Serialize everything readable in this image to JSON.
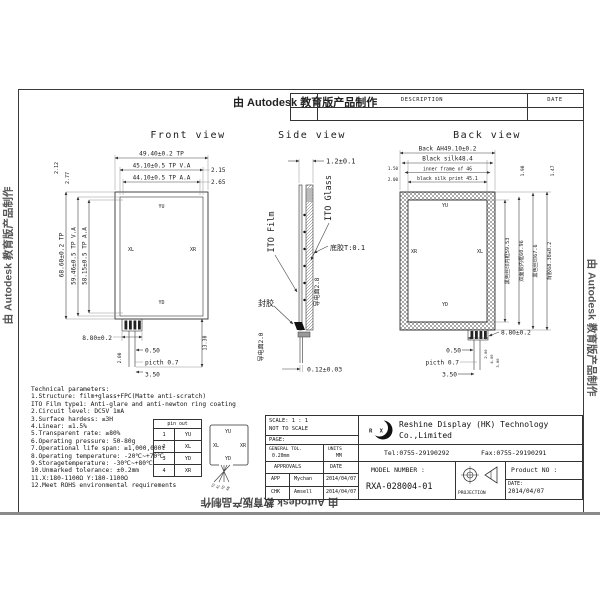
{
  "watermark": {
    "text": "由 Autodesk 教育版产品制作"
  },
  "revision_table": {
    "description": "DESCRIPTION",
    "date": "DATE"
  },
  "front": {
    "title": "Front view",
    "dim_width_tp": "49.40±0.2 TP",
    "dim_width_va": "45.10±0.5 TP V.A",
    "dim_width_aa": "44.10±0.5 TP A.A",
    "offset_va": "2.15",
    "offset_aa": "2.65",
    "offset_top1": "2.12",
    "offset_top2": "2.77",
    "dim_height_tp": "68.60±0.2 TP",
    "dim_height_va": "59.46±0.5 TP V.A",
    "dim_height_aa": "58.15±0.5 TP A.A",
    "tail_width": "8.80±0.2",
    "pin_w": "0.50",
    "pitch": "picth 0.7",
    "tail_end": "3.50",
    "tail_len": "13.30",
    "tail_off": "2.00",
    "el_top": "YU",
    "el_left": "XL",
    "el_right": "XR",
    "el_bottom": "YD"
  },
  "side": {
    "title": "Side view",
    "thickness": "1.2±0.1",
    "film": "ITO Film",
    "glass": "ITO Glass",
    "bottom_glue": "底胶T:0.1",
    "seal": "封胶",
    "conductive_a": "导电面2.8",
    "conductive_b": "导电面2.0",
    "fpc_t": "0.12±0.03"
  },
  "back": {
    "title": "Back view",
    "dim1": "Back AH49.10±0.2",
    "dim2": "Black silk48.4",
    "dim3": "inner frame of 46",
    "dim4": "black silk print 45.1",
    "off1": "1.50",
    "off2": "2.00",
    "off3": "1.90",
    "off4": "1.47",
    "v1": "黑色丝印内框59.53",
    "v2": "双面胶内框60.96",
    "v3": "黑色丝印67.6",
    "v4": "背胶68.30±0.2",
    "tail_width": "8.80±0.2",
    "pin_w": "0.50",
    "pitch": "picth 0.7",
    "tail_end": "3.50",
    "t1": "2.00",
    "t2": "4.00",
    "t3": "3.80",
    "el_top": "YU",
    "el_left": "XR",
    "el_right": "XL",
    "el_bottom": "YD"
  },
  "tech": {
    "title": "Technical parameters:",
    "lines": [
      "1.Structure: film+glass+FPC(Matte anti-scratch)",
      "ITO Film type1: Anti-glare and anti-newton ring coating",
      "2.Circuit level: DC5V 1mA",
      "3.Surface hardess: ≤3H",
      "4.Linear: ≤1.5%",
      "5.Transparent rate: ≥80%",
      "6.Operating pressure: 50-80g",
      "7.Operational life span: ≥1,000,000t",
      "8.Operating temperature: -20℃~+70℃",
      "9.Storagetemperature: -30℃~+80℃",
      "10.Unmarked tolerance: ±0.2mm",
      "11.X:180-1100Ω  Y:180-1100Ω",
      "12.Meet ROHS environmental requirements"
    ]
  },
  "pins": {
    "header": "pin out",
    "rows": [
      {
        "n": "1",
        "s": "YU"
      },
      {
        "n": "2",
        "s": "XL"
      },
      {
        "n": "3",
        "s": "YD"
      },
      {
        "n": "4",
        "s": "XR"
      }
    ],
    "mini": {
      "top": "YU",
      "left": "XL",
      "right": "XR",
      "bottom": "YD",
      "p1": "YU",
      "p2": "XL",
      "p3": "YD",
      "p4": "XR"
    }
  },
  "tb": {
    "scale": "SCALE: 1 : 1",
    "nts": "NOT TO SCALE",
    "page": "PAGE:",
    "gtol_label": "GENERAL TOL.",
    "gtol": "0.20mm",
    "units_label": "UNITS",
    "units": "MM",
    "approvals": "APPROVALS",
    "date_col": "DATE",
    "app_role": "APP",
    "app_name": "Mychan",
    "app_date": "2014/04/07",
    "chk_role": "CHK",
    "chk_name": "Amsell",
    "chk_date": "2014/04/07",
    "logo": "R X",
    "company1": "Reshine Display (HK) Technology",
    "company2": "Co.,Limited",
    "tel": "Tel:0755-29190292",
    "fax": "Fax:0755-29190291",
    "model_label": "MODEL NUMBER :",
    "model": "RXA-028004-01",
    "projection": "PROJECTION",
    "product_label": "Product NO :",
    "date_label": "DATE:",
    "date_value": "2014/04/07"
  }
}
